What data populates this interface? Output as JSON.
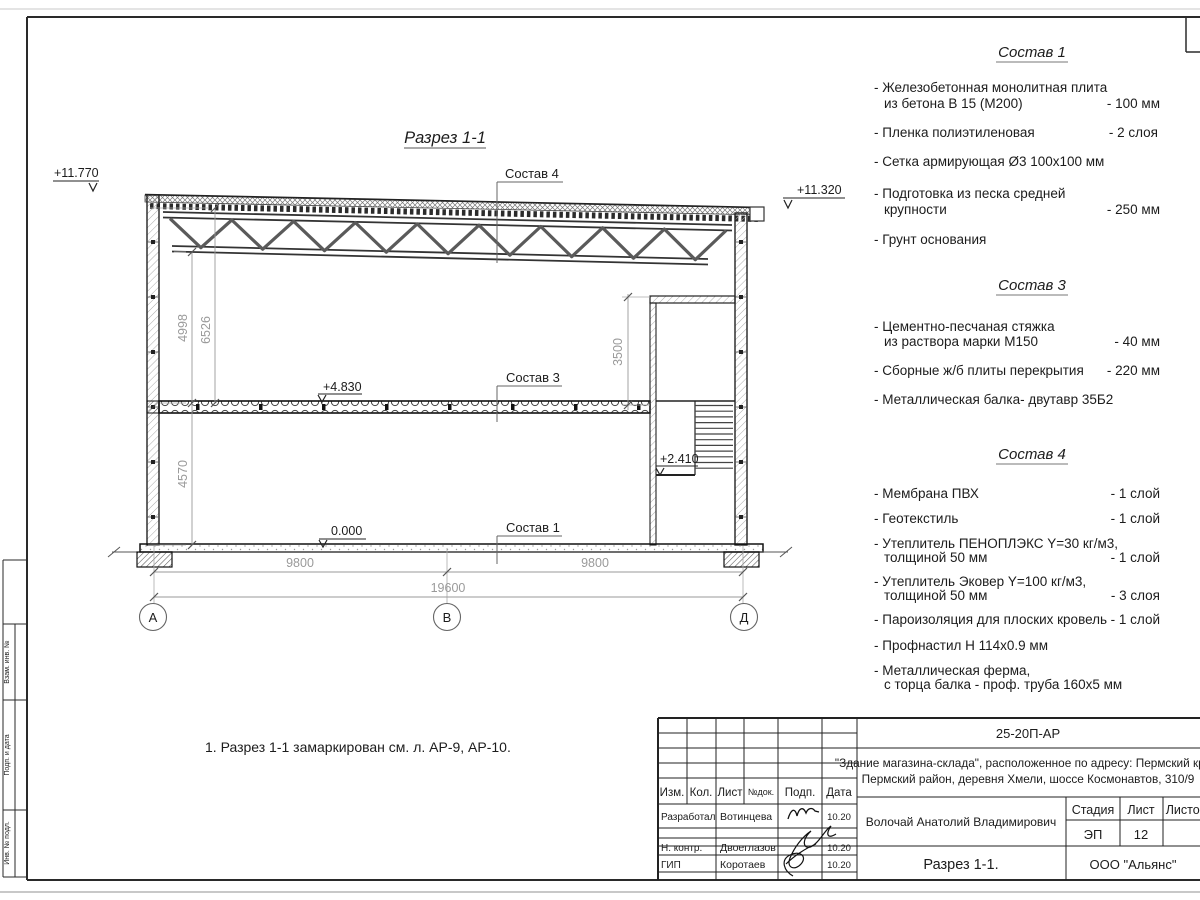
{
  "drawing": {
    "view_title": "Разрез 1-1",
    "note": "1. Разрез 1-1 замаркирован см. л. АР-9, АР-10.",
    "elevations": {
      "roof_high": "+11.770",
      "roof_low": "+11.320",
      "mezzanine": "+4.830",
      "landing": "+2.410",
      "ground": "0.000"
    },
    "dims": {
      "truss_bottom": "4998",
      "roof_top": "6526",
      "ground_floor": "4570",
      "stair_room": "3500",
      "bay1": "9800",
      "bay2": "9800",
      "total": "19600"
    },
    "axes": {
      "a": "А",
      "b": "В",
      "d": "Д"
    },
    "callout1": "Состав 1",
    "callout3": "Состав 3",
    "callout4": "Состав 4"
  },
  "lists": [
    {
      "title": "Состав 1",
      "items": [
        {
          "l1": "- Железобетонная  монолитная плита",
          "l2": "из бетона В 15 (М200)",
          "v": "- 100 мм"
        },
        {
          "l1": "- Пленка полиэтиленовая",
          "v": "-  2 слоя"
        },
        {
          "l1": "- Сетка армирующая Ø3 100х100 мм"
        },
        {
          "l1": "- Подготовка из песка средней",
          "l2": "крупности",
          "v": "- 250 мм"
        },
        {
          "l1": "- Грунт основания"
        }
      ]
    },
    {
      "title": "Состав 3",
      "items": [
        {
          "l1": "- Цементно-песчаная стяжка",
          "l2": "из раствора марки М150",
          "v": "- 40 мм"
        },
        {
          "l1": "- Сборные ж/б плиты перекрытия",
          "v": "- 220 мм"
        },
        {
          "l1": "- Металлическая балка- двутавр 35Б2"
        }
      ]
    },
    {
      "title": "Состав 4",
      "items": [
        {
          "l1": "- Мембрана ПВХ",
          "v": "- 1 слой"
        },
        {
          "l1": "- Геотекстиль",
          "v": "- 1 слой"
        },
        {
          "l1": "- Утеплитель ПЕНОПЛЭКС Y=30 кг/м3,",
          "l2": "толщиной 50 мм",
          "v": "- 1 слой"
        },
        {
          "l1": "- Утеплитель Эковер Y=100 кг/м3,",
          "l2": "толщиной 50 мм",
          "v": "- 3 слоя"
        },
        {
          "l1": "- Пароизоляция для плоских кровель",
          "v": "- 1 слой"
        },
        {
          "l1": "- Профнастил Н 114х0.9 мм"
        },
        {
          "l1": "- Металлическая ферма,",
          "l2": "с торца балка - проф. труба 160х5 мм"
        }
      ]
    }
  ],
  "titleblock": {
    "doc_number": "25-20П-АР",
    "object_line1": "\"Здание магазина-склада\", расположенное по адресу: Пермский край,",
    "object_line2": "Пермский район, деревня Хмели, шоссе Космонавтов, 310/9",
    "col_izm": "Изм.",
    "col_kol": "Кол.",
    "col_list": "Лист",
    "col_ndok": "№док.",
    "col_podp": "Подп.",
    "col_data": "Дата",
    "row1_role": "Разработал",
    "row1_name": "Вотинцева",
    "row1_date": "10.20",
    "row2_role": "Н. контр.",
    "row2_name": "Двоеглазов",
    "row2_date": "10.20",
    "row3_role": "ГИП",
    "row3_name": "Коротаев",
    "row3_date": "10.20",
    "chief_name": "Волочай Анатолий Владимирович",
    "stage_label": "Стадия",
    "sheet_label": "Лист",
    "sheets_label": "Листов",
    "stage": "ЭП",
    "sheet": "12",
    "sheet_title": "Разрез 1-1.",
    "company": "ООО \"Альянс\""
  },
  "side_stamp": {
    "label_top": "Взам. инв. №",
    "label_mid": "Подп. и дата",
    "label_bot": "Инв. № подл."
  },
  "colors": {
    "line": "#222222",
    "dim": "#9a9a9a",
    "hatch": "#999999",
    "paper_edge": "#c0c0c0"
  }
}
